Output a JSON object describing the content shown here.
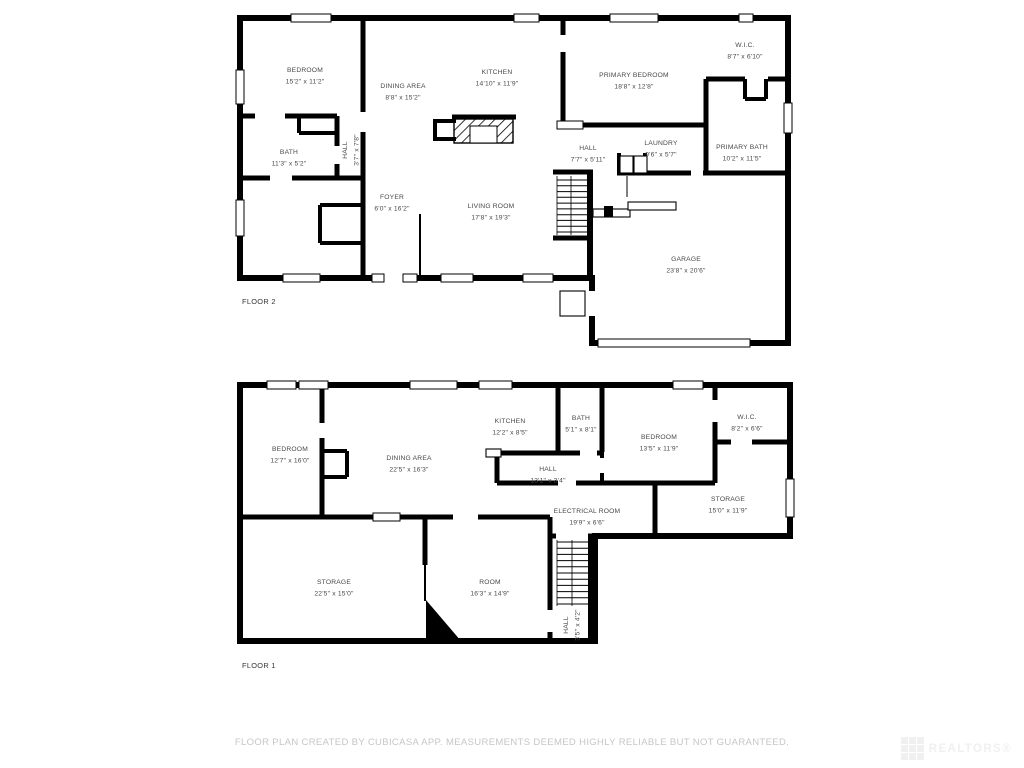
{
  "colors": {
    "wall": "#000000",
    "label": "#484848",
    "disclaimer": "#c6c6c6",
    "watermark": "#f0f0f0"
  },
  "footer": {
    "disclaimer": "FLOOR PLAN CREATED BY CUBICASA APP. MEASUREMENTS DEEMED HIGHLY RELIABLE BUT NOT GUARANTEED."
  },
  "watermark": {
    "text": "REALTORS®"
  },
  "floors": [
    {
      "name": "FLOOR 2",
      "rooms": [
        {
          "name": "BEDROOM",
          "dims": "15'2\" x 11'2\"",
          "x": 305,
          "y": 72,
          "vertical": false
        },
        {
          "name": "DINING AREA",
          "dims": "8'8\" x 15'2\"",
          "x": 403,
          "y": 88,
          "vertical": false
        },
        {
          "name": "KITCHEN",
          "dims": "14'10\" x 11'9\"",
          "x": 497,
          "y": 74,
          "vertical": false
        },
        {
          "name": "PRIMARY BEDROOM",
          "dims": "18'8\" x 12'8\"",
          "x": 634,
          "y": 77,
          "vertical": false
        },
        {
          "name": "W.I.C.",
          "dims": "8'7\" x 6'10\"",
          "x": 745,
          "y": 47,
          "vertical": false
        },
        {
          "name": "BATH",
          "dims": "11'3\" x 5'2\"",
          "x": 289,
          "y": 154,
          "vertical": false
        },
        {
          "name": "HALL",
          "dims": "3'7\" x 7'8\"",
          "x": 347,
          "y": 150,
          "vertical": true
        },
        {
          "name": "HALL",
          "dims": "7'7\" x 5'11\"",
          "x": 588,
          "y": 150,
          "vertical": false
        },
        {
          "name": "LAUNDRY",
          "dims": "9'6\" x 5'7\"",
          "x": 661,
          "y": 145,
          "vertical": false
        },
        {
          "name": "PRIMARY BATH",
          "dims": "10'2\" x 11'5\"",
          "x": 742,
          "y": 149,
          "vertical": false
        },
        {
          "name": "FOYER",
          "dims": "6'0\" x 16'2\"",
          "x": 392,
          "y": 199,
          "vertical": false
        },
        {
          "name": "LIVING ROOM",
          "dims": "17'8\" x 19'3\"",
          "x": 491,
          "y": 208,
          "vertical": false
        },
        {
          "name": "GARAGE",
          "dims": "23'8\" x 20'6\"",
          "x": 686,
          "y": 261,
          "vertical": false
        }
      ]
    },
    {
      "name": "FLOOR 1",
      "rooms": [
        {
          "name": "BEDROOM",
          "dims": "12'7\" x 16'0\"",
          "x": 290,
          "y": 451,
          "vertical": false
        },
        {
          "name": "DINING AREA",
          "dims": "22'5\" x 16'3\"",
          "x": 409,
          "y": 460,
          "vertical": false
        },
        {
          "name": "KITCHEN",
          "dims": "12'2\" x 8'5\"",
          "x": 510,
          "y": 423,
          "vertical": false
        },
        {
          "name": "BATH",
          "dims": "5'1\" x 8'1\"",
          "x": 581,
          "y": 420,
          "vertical": false
        },
        {
          "name": "BEDROOM",
          "dims": "13'5\" x 11'9\"",
          "x": 659,
          "y": 439,
          "vertical": false
        },
        {
          "name": "W.I.C.",
          "dims": "8'2\" x 6'6\"",
          "x": 747,
          "y": 419,
          "vertical": false
        },
        {
          "name": "HALL",
          "dims": "13'1\" x 3'4\"",
          "x": 548,
          "y": 471,
          "vertical": false
        },
        {
          "name": "ELECTRICAL ROOM",
          "dims": "19'9\" x 6'6\"",
          "x": 587,
          "y": 513,
          "vertical": false
        },
        {
          "name": "STORAGE",
          "dims": "15'0\" x 11'9\"",
          "x": 728,
          "y": 501,
          "vertical": false
        },
        {
          "name": "STORAGE",
          "dims": "22'5\" x 15'0\"",
          "x": 334,
          "y": 584,
          "vertical": false
        },
        {
          "name": "ROOM",
          "dims": "16'3\" x 14'9\"",
          "x": 490,
          "y": 584,
          "vertical": false
        },
        {
          "name": "HALL",
          "dims": "3'5\" x 4'2\"",
          "x": 568,
          "y": 625,
          "vertical": true
        }
      ]
    }
  ]
}
